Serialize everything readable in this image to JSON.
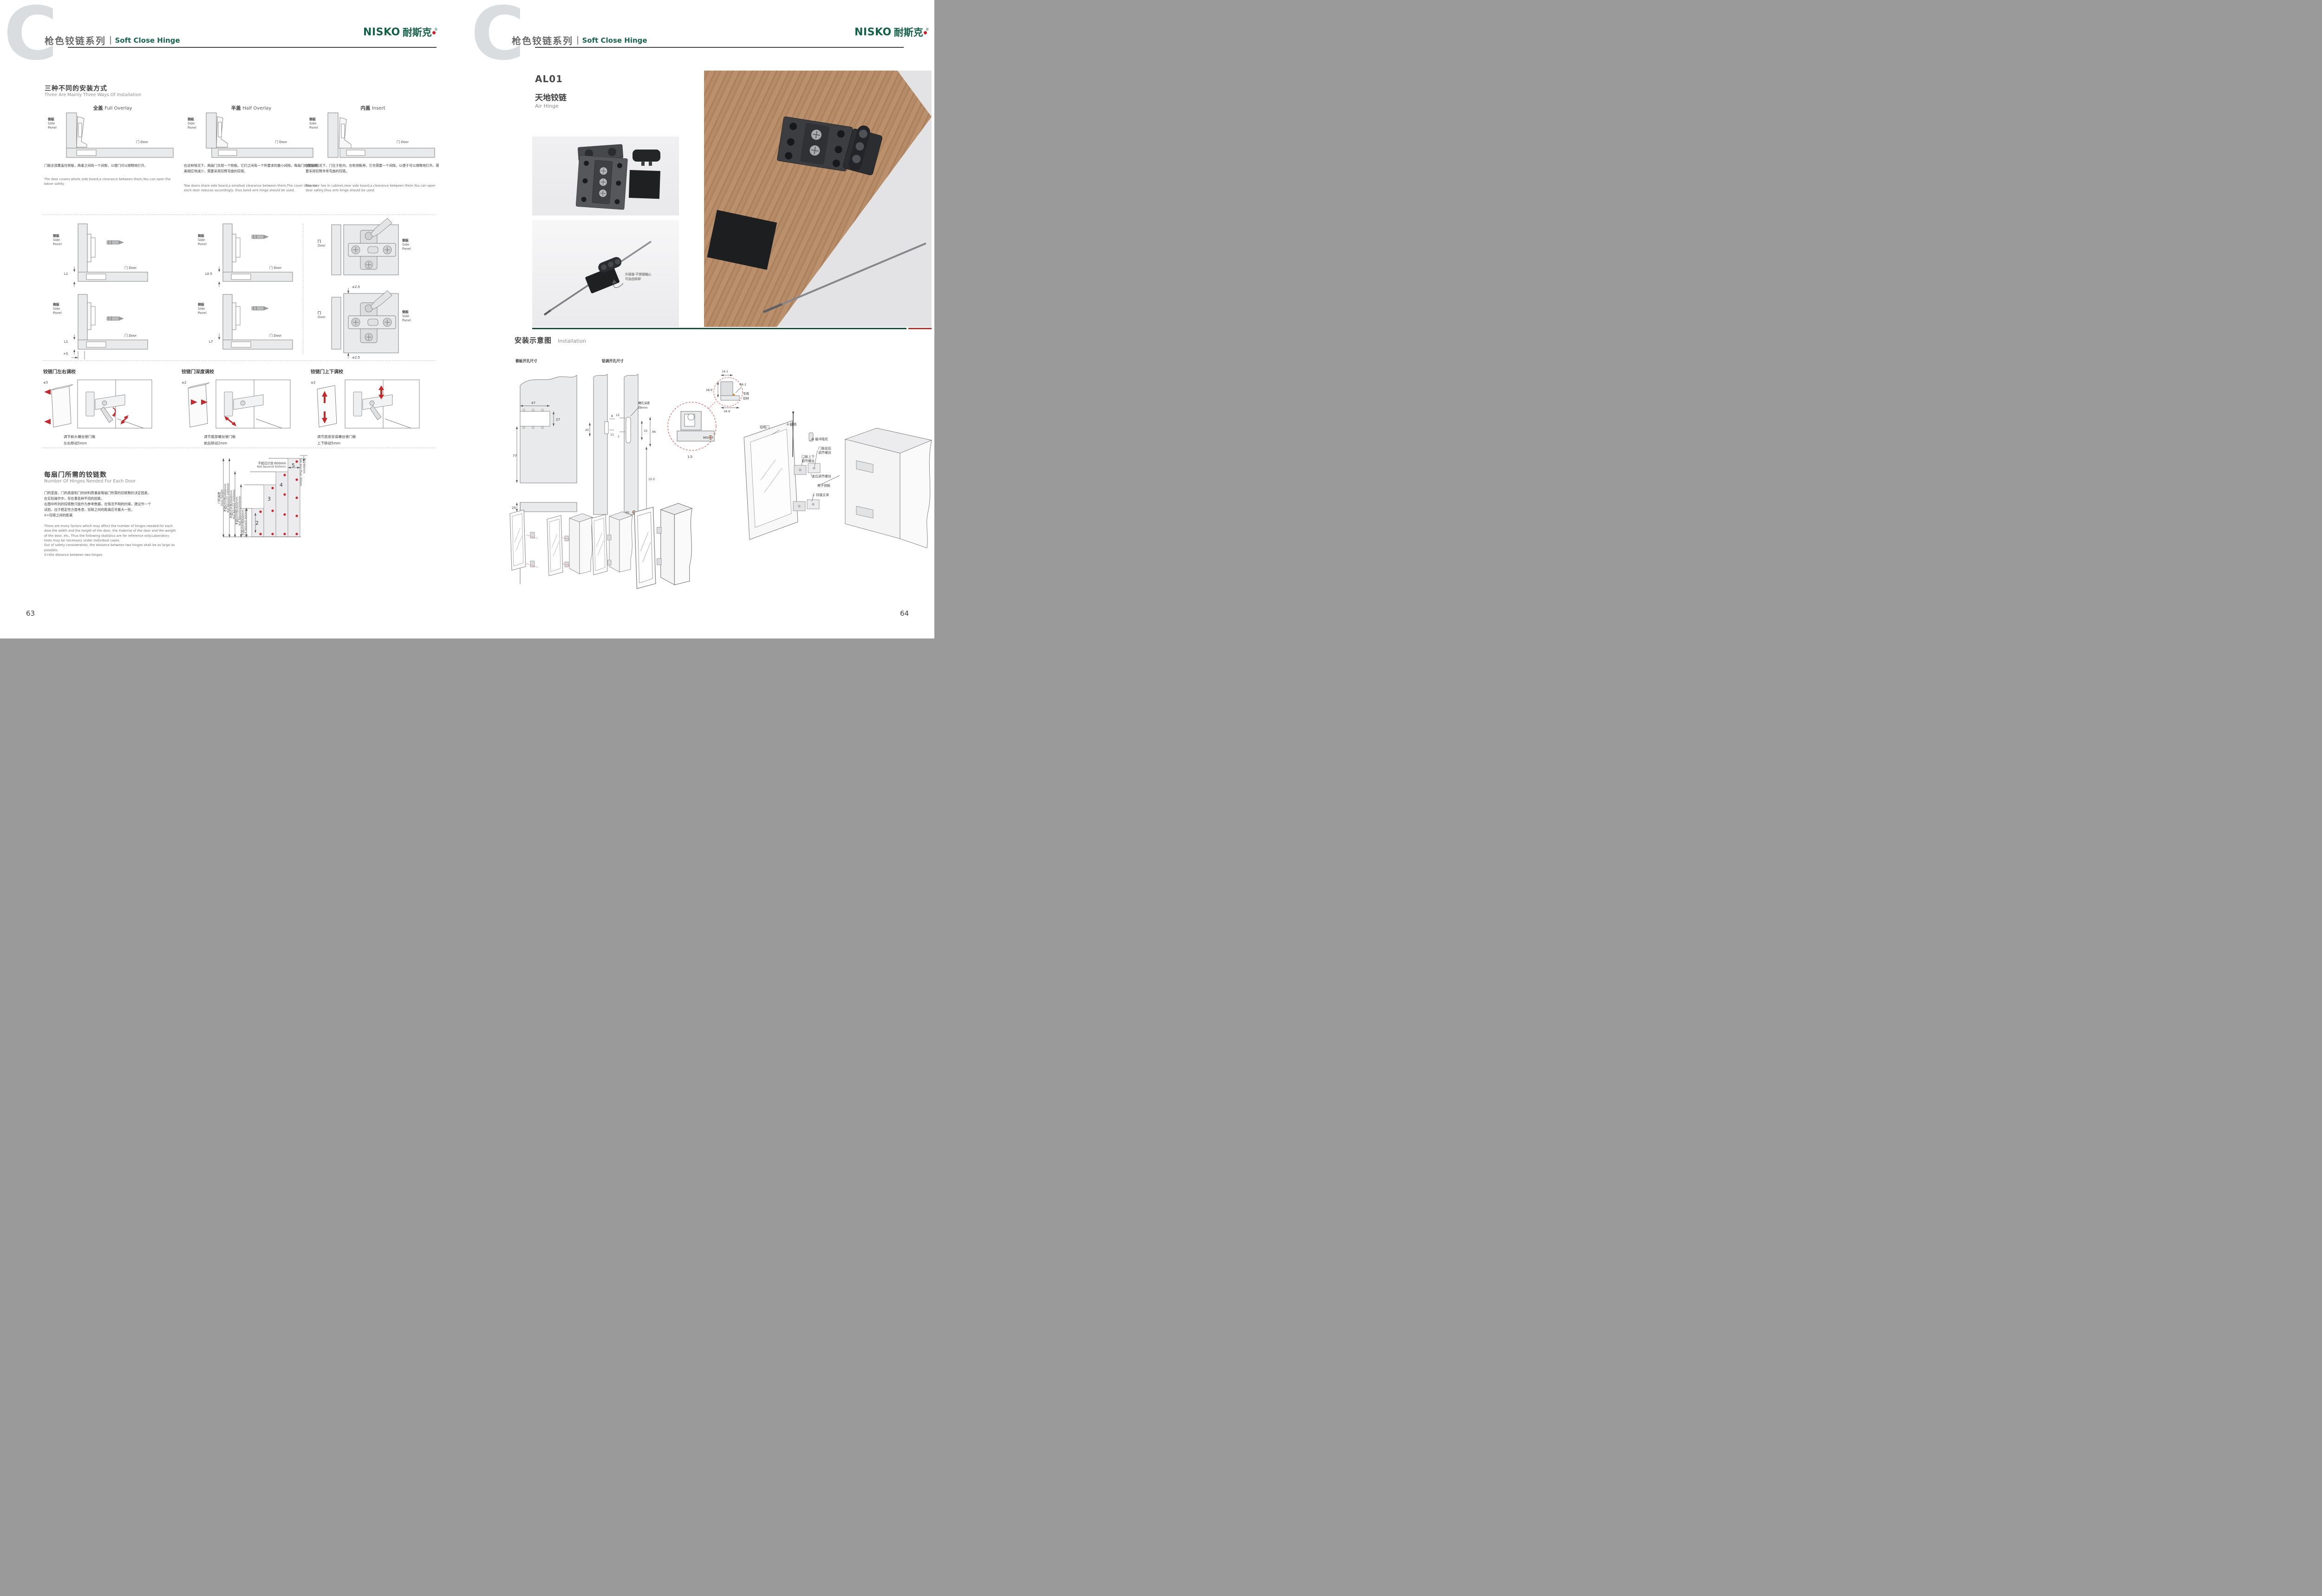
{
  "colors": {
    "brand_green": "#156048",
    "accent_red": "#c9252c",
    "header_gray": "#6b6b6b",
    "drawing_fill": "#e9eaeb",
    "wood_brown": "#b68c68"
  },
  "common": {
    "side_panel_cn": "侧板",
    "side_en": "Side",
    "panel_en": "Panel",
    "door_cn": "门",
    "door_en": "Door"
  },
  "logo": {
    "en": "NISKO",
    "cn": "耐斯克",
    "reg": "®"
  },
  "left_page": {
    "page_number": "63",
    "header": {
      "series_cn": "枪色铰链系列",
      "series_en": "Soft Close Hinge"
    },
    "methods": {
      "title_cn": "三种不同的安装方式",
      "title_en": "Three Are Mainly Three Ways Of Installation",
      "items": [
        {
          "name_cn": "全盖",
          "name_en": "Full Overlay",
          "desc_cn": "门板全部覆盖住侧板，两者之间有一个间隙，以便门可以顺畅地打开。",
          "desc_en": "The door covers whole side board,a clearance between them,You can open the bdoor safely."
        },
        {
          "name_cn": "半盖",
          "name_en": "Half Overlay",
          "desc_cn": "在这种情况下，两扇门共用一个侧板。它们之间有一个所要求的最小间隙。每扇门的覆盖距离相应地减少，需要采用铰臂弯曲的铰链。",
          "desc_en": "Tow doors share side board,a smallest clearance between them,The cover distance each door reduces accordingly, thus bend arm hinge should be used."
        },
        {
          "name_cn": "内盖",
          "name_en": "Insert",
          "desc_cn": "在这种情况下，门位于柜内，在柜侧板旁。它也需要一个间隙。以便于可以顺畅地打开。需要采用铰臂非常弯曲的铰链。",
          "desc_en": "Tow door lies in cabinet,near side board,a clearance between them.You can open door safely,thus arm hinge should be used."
        }
      ]
    },
    "clearance": {
      "dims": [
        "L1",
        "L0.5",
        "L1",
        "L7"
      ],
      "extra": "+5",
      "plate_tol": "±2.5"
    },
    "adjustments": [
      {
        "title": "铰链门左右调校",
        "tol": "±5",
        "line1": "调节前头螺丝使门板",
        "line2": "左右移动5mm"
      },
      {
        "title": "铰链门深度调校",
        "tol": "±2",
        "line1": "调节尾部螺丝使门板",
        "line2": "前后移动2mm"
      },
      {
        "title": "铰链门上下调校",
        "tol": "±2",
        "line1": "调节底座安装螺丝使门板",
        "line2": "上下移动5mm"
      }
    ],
    "hinge_count": {
      "title_cn": "每扇门所需的铰链数",
      "title_en": "Number Of Hinges Needed For Each Door",
      "desc_cn_lines": [
        "门的宽度，门的高度和门的材料质量是每扇门所需的铰链数的决定因素。",
        "在实际操作中，存在着各种不同的因素。",
        "右图中所列的铰链数只能作为参考数据，在情况不明的时候，建议作一个",
        "试验，出于稳定性方面考虑，铰链之间的距离应尽量大一些。",
        "X=铰链之间的距离"
      ],
      "desc_en_lines": [
        "There are many factors which may affect the number of hinges needed for each",
        "door.the width and the height of the door, the material of the door and the weight",
        "of the door, etc, Thus the following statistics are for reference only.Laboratory",
        "tests may be necessary under individual cases.",
        "Out of safety consideration, the distance between two hinges shall be as large as",
        "possible.",
        "X=the distance between two hinges"
      ],
      "chart": {
        "type": "step-diagram",
        "axis_cn": "门的高度",
        "axis_en": "Door height",
        "rows": [
          {
            "cn": "不超过计划2400mm",
            "en": "Not bevond 2400mm"
          },
          {
            "cn": "不超过计划2000mm",
            "en": "Not bevond 2000mm"
          },
          {
            "cn": "不超过计划1600mm",
            "en": "Not bevond 1600mm"
          },
          {
            "cn": "不超过计划900mm",
            "en": "Not bevond 900mm"
          }
        ],
        "top_cn": "不超过计划 600mm",
        "top_en": "Not bevond 600mm",
        "right_cn": "至少90mm",
        "right_en": "Not less than 90mm",
        "bars": [
          "2",
          "3",
          "4",
          "5"
        ]
      }
    }
  },
  "right_page": {
    "page_number": "64",
    "header": {
      "series_cn": "枪色铰链系列",
      "series_en": "Soft Close Hinge"
    },
    "product": {
      "code": "AL01",
      "name_cn": "天地铰链",
      "name_en": "Air Hinge"
    },
    "photo_note": {
      "line1": "升级版·不锈钢轴心",
      "line2": "可自由拆卸"
    },
    "installation": {
      "title_cn": "安装示意图",
      "title_en": "Installation",
      "side_drill": {
        "title": "侧板开孔尺寸",
        "w": "47",
        "h": "27",
        "v": "77",
        "b": "25"
      },
      "alu_drill": {
        "title": "铝调开孔尺寸",
        "slot_l1": "槽孔深度",
        "slot_l2": "18mm",
        "d8": "8",
        "d20": "20",
        "d11": "11",
        "d12": "12",
        "d1": "1",
        "d33": "33",
        "d46": "46",
        "d155": "15.5",
        "m5": "M5"
      },
      "profile": {
        "d141": "14.1",
        "d289": "28.9",
        "d349": "34.9",
        "dia": "Φ6.2",
        "note1": "专用",
        "note2": "铝材",
        "m5": "M5",
        "scale": "1:5"
      },
      "exploded": {
        "frame_door": "铝框门",
        "pin": "A 插销",
        "damper": "B 缓冲阻尼",
        "fb1": "门板前后",
        "fb2": "调节螺丝",
        "ud1": "门板上下",
        "ud2": "调节螺丝",
        "cover": "盖位调节螺丝",
        "side": "柜子侧板",
        "body": "C 铰链主体"
      }
    }
  }
}
